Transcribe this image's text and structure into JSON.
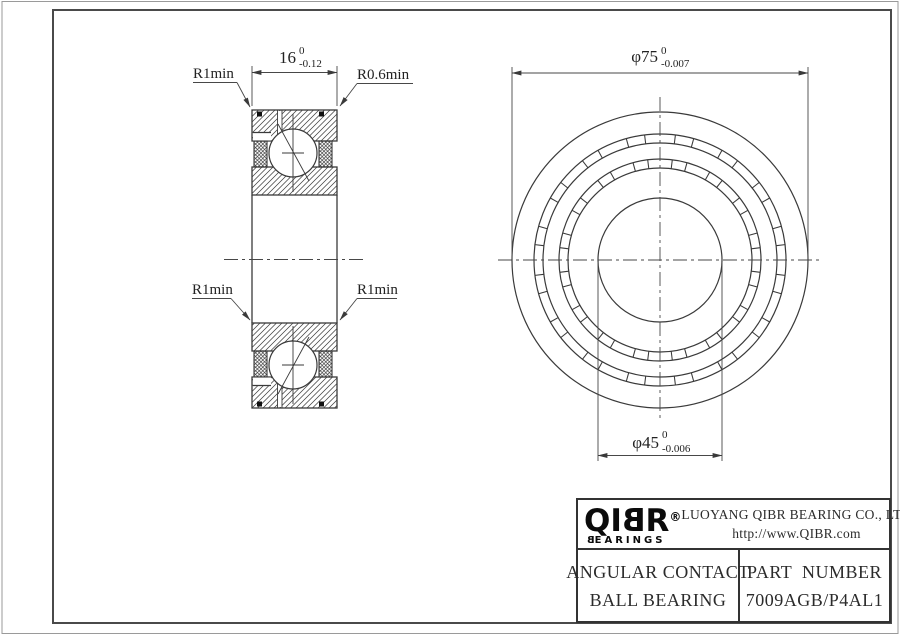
{
  "drawing": {
    "section_view": {
      "width_dim": {
        "value": "16",
        "tol_upper": "0",
        "tol_lower": "-0.12"
      },
      "labels": {
        "r1min_top_left": "R1min",
        "r06min_top_right": "R0.6min",
        "r1min_mid_left": "R1min",
        "r1min_mid_right": "R1min"
      }
    },
    "front_view": {
      "od_dim": {
        "value": "φ75",
        "tol_upper": "0",
        "tol_lower": "-0.007"
      },
      "bore_dim": {
        "value": "φ45",
        "tol_upper": "0",
        "tol_lower": "-0.006"
      }
    }
  },
  "title_block": {
    "logo": {
      "q": "Q",
      "i": "I",
      "b": "B",
      "r": "R",
      "reg": "®",
      "sub_first": "B",
      "sub_rest": "EARINGS"
    },
    "company": "LUOYANG QIBR BEARING CO., LTD",
    "website": "http://www.QIBR.com",
    "product_line1": "ANGULAR CONTACT",
    "product_line2": "BALL BEARING",
    "part_label": "PART  NUMBER",
    "part_number": "7009AGB/P4AL1"
  }
}
